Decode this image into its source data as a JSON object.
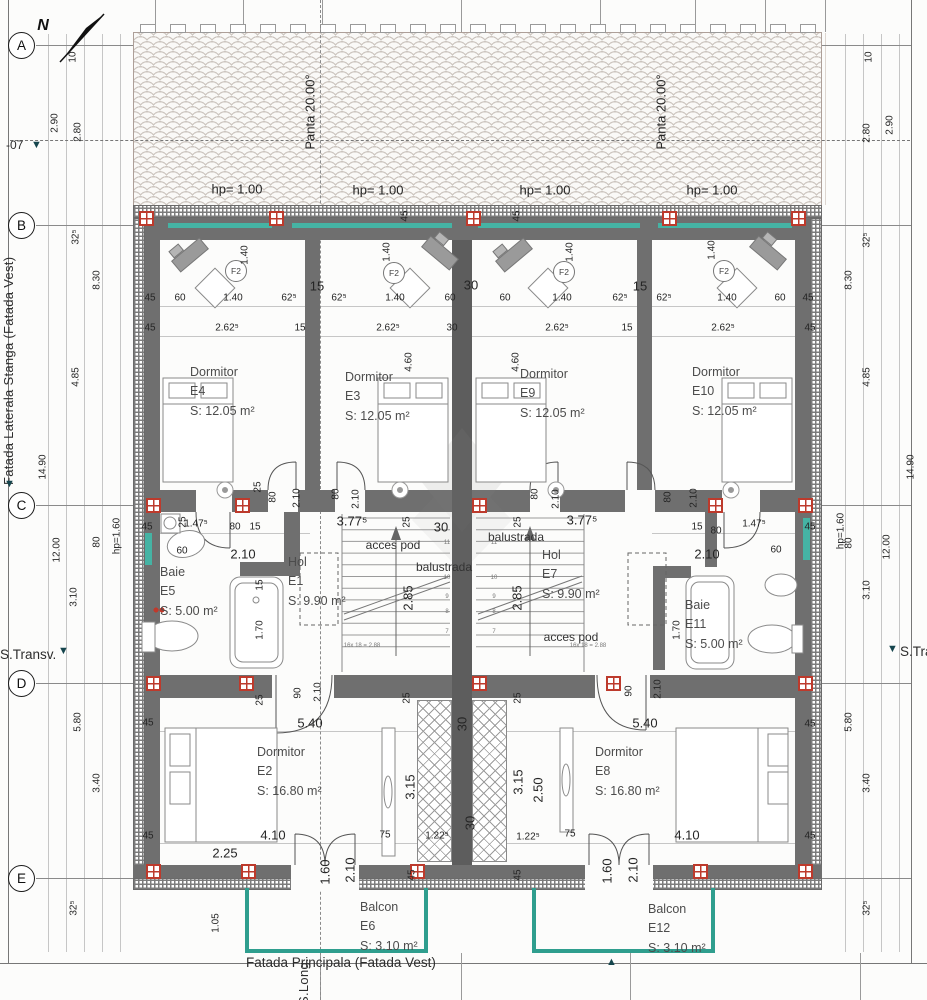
{
  "drawing": {
    "north_label": "N",
    "level_marker": "-07",
    "facade_left": "Fatada Laterala Stanga (Fatada Vest)",
    "facade_bottom": "Fatada Principala (Fatada Vest)",
    "section_transversal": "S.Transv.",
    "section_longitudinal": "S.Long.",
    "tri_down": "▼",
    "tri_up": "▲"
  },
  "grid_rows": [
    {
      "label": "A",
      "y": 45
    },
    {
      "label": "B",
      "y": 225
    },
    {
      "label": "C",
      "y": 505
    },
    {
      "label": "D",
      "y": 683
    },
    {
      "label": "E",
      "y": 878
    }
  ],
  "rooms": [
    {
      "name": "Dormitor",
      "id": "E4",
      "area": "S: 12.05 m²",
      "x": 190,
      "y": 363
    },
    {
      "name": "Dormitor",
      "id": "E3",
      "area": "S: 12.05 m²",
      "x": 345,
      "y": 368
    },
    {
      "name": "Dormitor",
      "id": "E9",
      "area": "S: 12.05 m²",
      "x": 520,
      "y": 365
    },
    {
      "name": "Dormitor",
      "id": "E10",
      "area": "S: 12.05 m²",
      "x": 692,
      "y": 363
    },
    {
      "name": "Hol",
      "id": "E1",
      "area": "S: 9.90 m²",
      "x": 288,
      "y": 553
    },
    {
      "name": "Hol",
      "id": "E7",
      "area": "S: 9.90 m²",
      "x": 542,
      "y": 546
    },
    {
      "name": "Baie",
      "id": "E5",
      "area": "S: 5.00 m²",
      "x": 160,
      "y": 563
    },
    {
      "name": "Baie",
      "id": "E11",
      "area": "S: 5.00 m²",
      "x": 685,
      "y": 596
    },
    {
      "name": "Dormitor",
      "id": "E2",
      "area": "S: 16.80 m²",
      "x": 257,
      "y": 743
    },
    {
      "name": "Dormitor",
      "id": "E8",
      "area": "S: 16.80 m²",
      "x": 595,
      "y": 743
    },
    {
      "name": "Balcon",
      "id": "E6",
      "area": "S: 3.10 m²",
      "x": 360,
      "y": 898
    },
    {
      "name": "Balcon",
      "id": "E12",
      "area": "S: 3.10 m²",
      "x": 648,
      "y": 900
    }
  ],
  "window_tags": [
    {
      "label": "F2",
      "x": 235,
      "y": 270
    },
    {
      "label": "F2",
      "x": 393,
      "y": 272
    },
    {
      "label": "F2",
      "x": 563,
      "y": 271
    },
    {
      "label": "F2",
      "x": 723,
      "y": 270
    }
  ],
  "dim_labels": [
    {
      "t": "10",
      "x": 73,
      "y": 57,
      "v": 1
    },
    {
      "t": "2.90",
      "x": 55,
      "y": 123,
      "v": 1
    },
    {
      "t": "2.80",
      "x": 78,
      "y": 132,
      "v": 1
    },
    {
      "t": "10",
      "x": 869,
      "y": 57,
      "v": 1
    },
    {
      "t": "2.80",
      "x": 867,
      "y": 133,
      "v": 1
    },
    {
      "t": "2.90",
      "x": 890,
      "y": 125,
      "v": 1
    },
    {
      "t": "Panta 20.00°",
      "x": 310,
      "y": 112,
      "v": 1,
      "b": 1
    },
    {
      "t": "Panta 20.00°",
      "x": 661,
      "y": 112,
      "v": 1,
      "b": 1
    },
    {
      "t": "hp= 1.00",
      "x": 237,
      "y": 189,
      "b": 1
    },
    {
      "t": "hp= 1.00",
      "x": 378,
      "y": 190,
      "b": 1
    },
    {
      "t": "hp= 1.00",
      "x": 545,
      "y": 190,
      "b": 1
    },
    {
      "t": "hp= 1.00",
      "x": 712,
      "y": 190,
      "b": 1
    },
    {
      "t": "32⁵",
      "x": 76,
      "y": 237,
      "v": 1
    },
    {
      "t": "8.30",
      "x": 97,
      "y": 280,
      "v": 1
    },
    {
      "t": "4.85",
      "x": 76,
      "y": 377,
      "v": 1
    },
    {
      "t": "14.90",
      "x": 43,
      "y": 467,
      "v": 1
    },
    {
      "t": "12.00",
      "x": 57,
      "y": 550,
      "v": 1
    },
    {
      "t": "3.10",
      "x": 74,
      "y": 597,
      "v": 1
    },
    {
      "t": "80",
      "x": 97,
      "y": 542,
      "v": 1
    },
    {
      "t": "hp=1.60",
      "x": 117,
      "y": 536,
      "v": 1
    },
    {
      "t": "5.80",
      "x": 78,
      "y": 722,
      "v": 1
    },
    {
      "t": "3.40",
      "x": 97,
      "y": 783,
      "v": 1
    },
    {
      "t": "1.05",
      "x": 216,
      "y": 923,
      "v": 1
    },
    {
      "t": "32⁵",
      "x": 74,
      "y": 908,
      "v": 1
    },
    {
      "t": "32⁵",
      "x": 867,
      "y": 240,
      "v": 1
    },
    {
      "t": "8.30",
      "x": 849,
      "y": 280,
      "v": 1
    },
    {
      "t": "4.85",
      "x": 867,
      "y": 377,
      "v": 1
    },
    {
      "t": "14.90",
      "x": 911,
      "y": 467,
      "v": 1
    },
    {
      "t": "12.00",
      "x": 887,
      "y": 547,
      "v": 1
    },
    {
      "t": "3.10",
      "x": 867,
      "y": 590,
      "v": 1
    },
    {
      "t": "80",
      "x": 849,
      "y": 543,
      "v": 1
    },
    {
      "t": "hp=1.60",
      "x": 841,
      "y": 531,
      "v": 1
    },
    {
      "t": "5.80",
      "x": 849,
      "y": 722,
      "v": 1
    },
    {
      "t": "3.40",
      "x": 867,
      "y": 783,
      "v": 1
    },
    {
      "t": "32⁵",
      "x": 867,
      "y": 908,
      "v": 1
    },
    {
      "t": "45",
      "x": 150,
      "y": 298
    },
    {
      "t": "60",
      "x": 180,
      "y": 298
    },
    {
      "t": "1.40",
      "x": 233,
      "y": 298
    },
    {
      "t": "62⁵",
      "x": 289,
      "y": 298
    },
    {
      "t": "15",
      "x": 317,
      "y": 286,
      "b": 1
    },
    {
      "t": "62⁵",
      "x": 339,
      "y": 298
    },
    {
      "t": "1.40",
      "x": 395,
      "y": 298
    },
    {
      "t": "60",
      "x": 450,
      "y": 298
    },
    {
      "t": "30",
      "x": 471,
      "y": 285,
      "b": 1
    },
    {
      "t": "60",
      "x": 505,
      "y": 298
    },
    {
      "t": "1.40",
      "x": 562,
      "y": 298
    },
    {
      "t": "62⁵",
      "x": 620,
      "y": 298
    },
    {
      "t": "15",
      "x": 640,
      "y": 286,
      "b": 1
    },
    {
      "t": "62⁵",
      "x": 664,
      "y": 298
    },
    {
      "t": "1.40",
      "x": 727,
      "y": 298
    },
    {
      "t": "60",
      "x": 780,
      "y": 298
    },
    {
      "t": "45",
      "x": 808,
      "y": 298
    },
    {
      "t": "45",
      "x": 150,
      "y": 328
    },
    {
      "t": "2.62⁵",
      "x": 227,
      "y": 328
    },
    {
      "t": "15",
      "x": 300,
      "y": 328
    },
    {
      "t": "2.62⁵",
      "x": 388,
      "y": 328
    },
    {
      "t": "30",
      "x": 452,
      "y": 328
    },
    {
      "t": "2.62⁵",
      "x": 557,
      "y": 328
    },
    {
      "t": "15",
      "x": 627,
      "y": 328
    },
    {
      "t": "2.62⁵",
      "x": 723,
      "y": 328
    },
    {
      "t": "45",
      "x": 810,
      "y": 328
    },
    {
      "t": "45",
      "x": 405,
      "y": 216,
      "v": 1
    },
    {
      "t": "45",
      "x": 517,
      "y": 216,
      "v": 1
    },
    {
      "t": "1.40",
      "x": 245,
      "y": 255,
      "v": 1
    },
    {
      "t": "1.40",
      "x": 387,
      "y": 252,
      "v": 1
    },
    {
      "t": "1.40",
      "x": 570,
      "y": 252,
      "v": 1
    },
    {
      "t": "1.40",
      "x": 712,
      "y": 250,
      "v": 1
    },
    {
      "t": "4.60",
      "x": 409,
      "y": 362,
      "v": 1
    },
    {
      "t": "4.60",
      "x": 516,
      "y": 362,
      "v": 1
    },
    {
      "t": "45",
      "x": 147,
      "y": 527
    },
    {
      "t": "1.47⁵",
      "x": 196,
      "y": 524
    },
    {
      "t": "80",
      "x": 235,
      "y": 527
    },
    {
      "t": "15",
      "x": 255,
      "y": 527
    },
    {
      "t": "60",
      "x": 182,
      "y": 551
    },
    {
      "t": "2.10",
      "x": 243,
      "y": 554,
      "b": 1
    },
    {
      "t": "25",
      "x": 183,
      "y": 522,
      "v": 1
    },
    {
      "t": "80",
      "x": 273,
      "y": 497,
      "v": 1
    },
    {
      "t": "2.10",
      "x": 297,
      "y": 498,
      "v": 1
    },
    {
      "t": "25",
      "x": 258,
      "y": 487,
      "v": 1
    },
    {
      "t": "80",
      "x": 336,
      "y": 494,
      "v": 1
    },
    {
      "t": "2.10",
      "x": 356,
      "y": 499,
      "v": 1
    },
    {
      "t": "3.77⁵",
      "x": 352,
      "y": 521,
      "b": 1
    },
    {
      "t": "25",
      "x": 407,
      "y": 522,
      "v": 1
    },
    {
      "t": "30",
      "x": 441,
      "y": 527,
      "b": 1
    },
    {
      "t": "25",
      "x": 518,
      "y": 522,
      "v": 1
    },
    {
      "t": "3.77⁵",
      "x": 582,
      "y": 520,
      "b": 1
    },
    {
      "t": "80",
      "x": 535,
      "y": 494,
      "v": 1
    },
    {
      "t": "2.10",
      "x": 556,
      "y": 499,
      "v": 1
    },
    {
      "t": "80",
      "x": 668,
      "y": 497,
      "v": 1
    },
    {
      "t": "2.10",
      "x": 694,
      "y": 498,
      "v": 1
    },
    {
      "t": "15",
      "x": 697,
      "y": 527
    },
    {
      "t": "80",
      "x": 716,
      "y": 531
    },
    {
      "t": "1.47⁵",
      "x": 754,
      "y": 524
    },
    {
      "t": "45",
      "x": 810,
      "y": 527
    },
    {
      "t": "2.10",
      "x": 707,
      "y": 554,
      "b": 1
    },
    {
      "t": "60",
      "x": 776,
      "y": 550
    },
    {
      "t": "15",
      "x": 260,
      "y": 585,
      "v": 1
    },
    {
      "t": "1.70",
      "x": 260,
      "y": 630,
      "v": 1
    },
    {
      "t": "1.70",
      "x": 677,
      "y": 630,
      "v": 1
    },
    {
      "t": "2.85",
      "x": 408,
      "y": 598,
      "v": 1,
      "b": 1
    },
    {
      "t": "2.85",
      "x": 517,
      "y": 598,
      "v": 1,
      "b": 1
    },
    {
      "t": "25",
      "x": 260,
      "y": 700,
      "v": 1
    },
    {
      "t": "90",
      "x": 298,
      "y": 693,
      "v": 1
    },
    {
      "t": "2.10",
      "x": 318,
      "y": 692,
      "v": 1
    },
    {
      "t": "5.40",
      "x": 310,
      "y": 723,
      "b": 1
    },
    {
      "t": "45",
      "x": 148,
      "y": 723
    },
    {
      "t": "25",
      "x": 407,
      "y": 698,
      "v": 1
    },
    {
      "t": "30",
      "x": 462,
      "y": 724,
      "v": 1,
      "b": 1
    },
    {
      "t": "25",
      "x": 518,
      "y": 698,
      "v": 1
    },
    {
      "t": "90",
      "x": 629,
      "y": 691,
      "v": 1
    },
    {
      "t": "2.10",
      "x": 658,
      "y": 689,
      "v": 1
    },
    {
      "t": "5.40",
      "x": 645,
      "y": 723,
      "b": 1
    },
    {
      "t": "45",
      "x": 810,
      "y": 724
    },
    {
      "t": "3.15",
      "x": 410,
      "y": 787,
      "v": 1,
      "b": 1
    },
    {
      "t": "3.15",
      "x": 518,
      "y": 782,
      "v": 1,
      "b": 1
    },
    {
      "t": "2.50",
      "x": 538,
      "y": 790,
      "v": 1,
      "b": 1
    },
    {
      "t": "30",
      "x": 470,
      "y": 823,
      "v": 1,
      "b": 1
    },
    {
      "t": "4.10",
      "x": 273,
      "y": 835,
      "b": 1
    },
    {
      "t": "75",
      "x": 385,
      "y": 835
    },
    {
      "t": "1.22⁵",
      "x": 437,
      "y": 836
    },
    {
      "t": "1.22⁵",
      "x": 528,
      "y": 837
    },
    {
      "t": "75",
      "x": 570,
      "y": 834
    },
    {
      "t": "4.10",
      "x": 687,
      "y": 835,
      "b": 1
    },
    {
      "t": "45",
      "x": 148,
      "y": 836
    },
    {
      "t": "45",
      "x": 810,
      "y": 836
    },
    {
      "t": "2.25",
      "x": 225,
      "y": 853,
      "b": 1
    },
    {
      "t": "1.60",
      "x": 325,
      "y": 872,
      "v": 1,
      "b": 1
    },
    {
      "t": "2.10",
      "x": 350,
      "y": 870,
      "v": 1,
      "b": 1
    },
    {
      "t": "1.60",
      "x": 607,
      "y": 871,
      "v": 1,
      "b": 1
    },
    {
      "t": "2.10",
      "x": 633,
      "y": 870,
      "v": 1,
      "b": 1
    },
    {
      "t": "45",
      "x": 412,
      "y": 875,
      "v": 1
    },
    {
      "t": "45",
      "x": 518,
      "y": 875,
      "v": 1
    }
  ],
  "note_labels": [
    {
      "t": "N",
      "x": 43,
      "y": 26,
      "n": 1
    },
    {
      "t": "acces pod",
      "x": 393,
      "y": 545
    },
    {
      "t": "balustrada",
      "x": 444,
      "y": 567
    },
    {
      "t": "balustrada",
      "x": 516,
      "y": 537
    },
    {
      "t": "acces pod",
      "x": 571,
      "y": 637
    },
    {
      "t": "16x 18 = 2.88",
      "x": 362,
      "y": 646,
      "s": 1
    },
    {
      "t": "16x 18 = 2.88",
      "x": 588,
      "y": 646,
      "s": 1
    },
    {
      "t": "11",
      "x": 447,
      "y": 543,
      "s": 1
    },
    {
      "t": "10",
      "x": 447,
      "y": 578,
      "s": 1
    },
    {
      "t": "9",
      "x": 447,
      "y": 597,
      "s": 1
    },
    {
      "t": "8",
      "x": 447,
      "y": 612,
      "s": 1
    },
    {
      "t": "7",
      "x": 447,
      "y": 632,
      "s": 1
    },
    {
      "t": "11",
      "x": 494,
      "y": 543,
      "s": 1
    },
    {
      "t": "10",
      "x": 494,
      "y": 578,
      "s": 1
    },
    {
      "t": "9",
      "x": 494,
      "y": 597,
      "s": 1
    },
    {
      "t": "8",
      "x": 494,
      "y": 612,
      "s": 1
    },
    {
      "t": "7",
      "x": 494,
      "y": 632,
      "s": 1
    }
  ],
  "markers": [
    [
      146,
      218
    ],
    [
      276,
      218
    ],
    [
      473,
      218
    ],
    [
      669,
      218
    ],
    [
      798,
      218
    ],
    [
      153,
      505
    ],
    [
      242,
      505
    ],
    [
      479,
      505
    ],
    [
      715,
      505
    ],
    [
      805,
      505
    ],
    [
      153,
      683
    ],
    [
      246,
      683
    ],
    [
      479,
      683
    ],
    [
      613,
      683
    ],
    [
      805,
      683
    ],
    [
      153,
      871
    ],
    [
      248,
      871
    ],
    [
      417,
      871
    ],
    [
      700,
      871
    ],
    [
      805,
      871
    ]
  ],
  "colors": {
    "wall": "#6f6f6f",
    "party_wall": "#5d5d5d",
    "window_teal": "#45b3a4",
    "rail_teal": "#2f9e8e",
    "marker_red": "#bd3a2c",
    "roof_tile": "#ccc5bf",
    "section_teal": "#15454d"
  }
}
